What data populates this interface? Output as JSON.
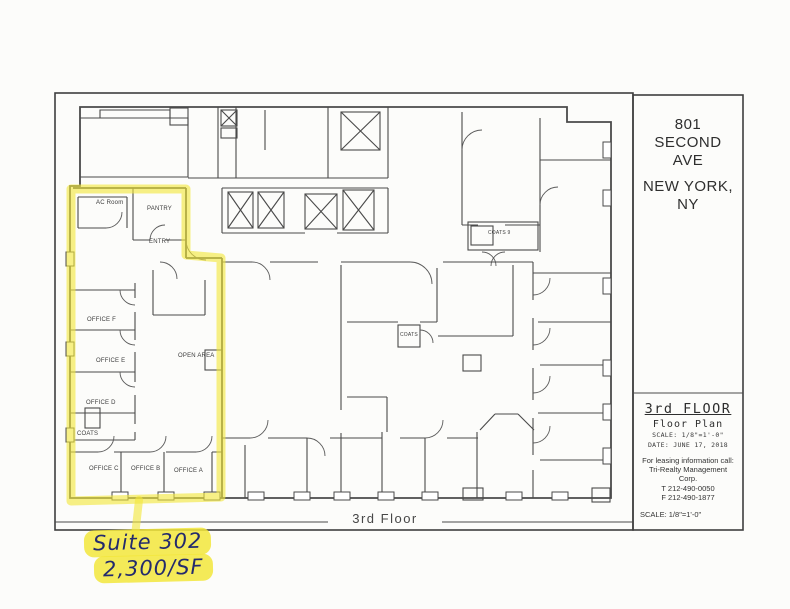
{
  "colors": {
    "highlight": "#f2e63b",
    "ink": "#232a6d",
    "line": "#4a4a4a",
    "paper": "#fcfcfa"
  },
  "title_block": {
    "address_lines": [
      "801",
      "SECOND",
      "AVE"
    ],
    "city_lines": [
      "NEW YORK,",
      "NY"
    ],
    "floor_title": "3rd FLOOR",
    "subtitle": "Floor Plan",
    "scale_note": "SCALE: 1/8\"=1'-0\"",
    "date_note": "DATE: JUNE 17, 2018",
    "leasing_lines": [
      "For leasing information call:",
      "Tri-Realty Management",
      "Corp.",
      "T 212-490-0050",
      "F 212-490-1877"
    ],
    "scale_footer": "SCALE: 1/8\"=1'-0\""
  },
  "plan": {
    "floor_label": "3rd Floor",
    "room_labels": {
      "ac_room": "AC Room",
      "pantry": "PANTRY",
      "entry": "ENTRY",
      "office_f": "OFFICE F",
      "office_e": "OFFICE E",
      "office_d": "OFFICE D",
      "coats_left": "COATS",
      "office_c": "OFFICE C",
      "office_b": "OFFICE B",
      "office_a": "OFFICE A",
      "open_area": "OPEN AREA",
      "coats_mid": "COATS",
      "coats_9": "COATS 9"
    }
  },
  "annotation": {
    "suite_line": "Suite 302",
    "size_line": "2,300/SF"
  }
}
